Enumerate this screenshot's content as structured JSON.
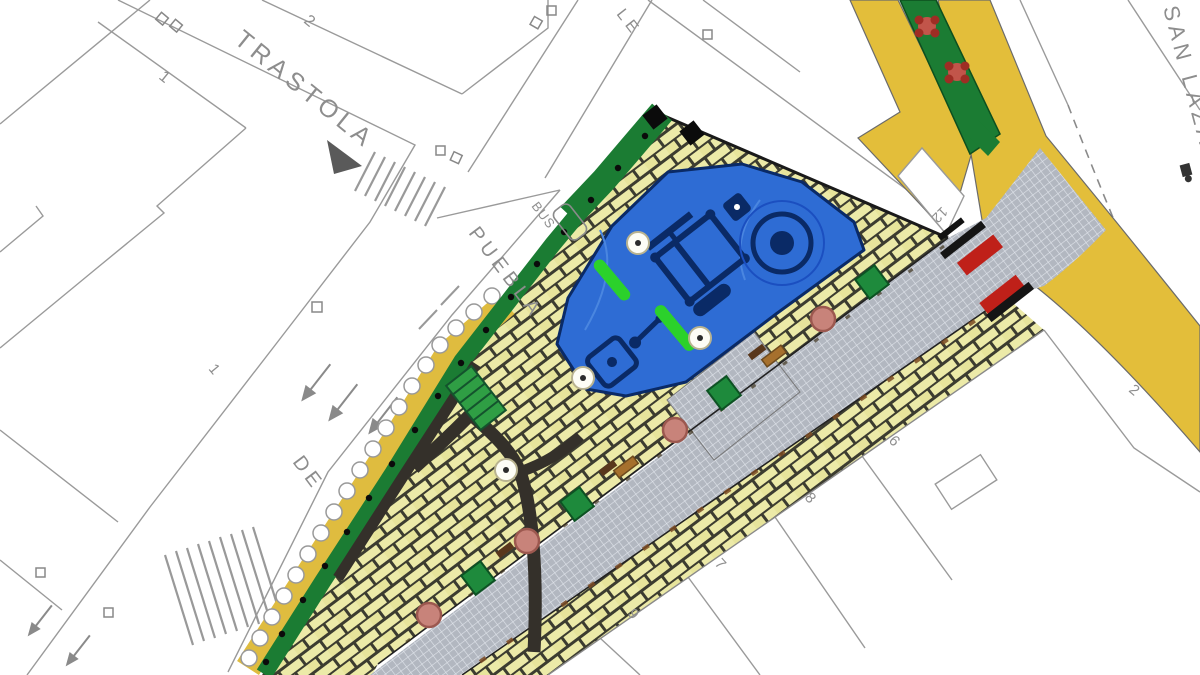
{
  "title": "Plaza renovation site plan",
  "labels": {
    "street_trastola": "TRASTOLA",
    "street_puebla": "PUEBLA",
    "street_de": "DE",
    "street_san_lazaro": "SAN LAZARO",
    "street_partial": "LE",
    "bus_stop": "BUS"
  },
  "numbers": {
    "n_top_left_1": "1",
    "n_top_left_2": "2",
    "n_mid_left_1": "1",
    "n_parcel_12": "12",
    "n_parcel_2": "2",
    "n_parcel_6": "6",
    "n_parcel_8": "8",
    "n_parcel_7": "7",
    "n_parcel_9": "9"
  },
  "symbols": {
    "playground": "playground-area",
    "trees_white": "tree-symbol",
    "trees_pink": "tree-canopy-pink",
    "shrubs_green": "shrub-square-green",
    "benches": "bench",
    "flower_trees": "flowering-tree",
    "crossing_marks": "pedestrian-crossing-marker",
    "zebra": "zebra-crossing",
    "hedge": "hedge-scallops",
    "stairs": "steps",
    "bus_shelter": "bus-shelter"
  },
  "colors": {
    "paper": "#FFFFFF",
    "cad_line": "#9A9A9A",
    "brick_paving": "#ECEAA8",
    "brick_joint": "#3C3C30",
    "road_gray": "#B2B7C0",
    "road_hatch": "#DFE3EA",
    "asphalt_yellow": "#E3BE3A",
    "green_strip": "#1B7C33",
    "bright_green": "#2BD12B",
    "playground_blue": "#2E6CD4",
    "playground_outline": "#0A2A66",
    "red_marking": "#BF2019",
    "pink_tree": "#C8837A",
    "bench_brown": "#A6702D",
    "dark_path": "#34302A",
    "stairs_green": "#2F9E44"
  }
}
